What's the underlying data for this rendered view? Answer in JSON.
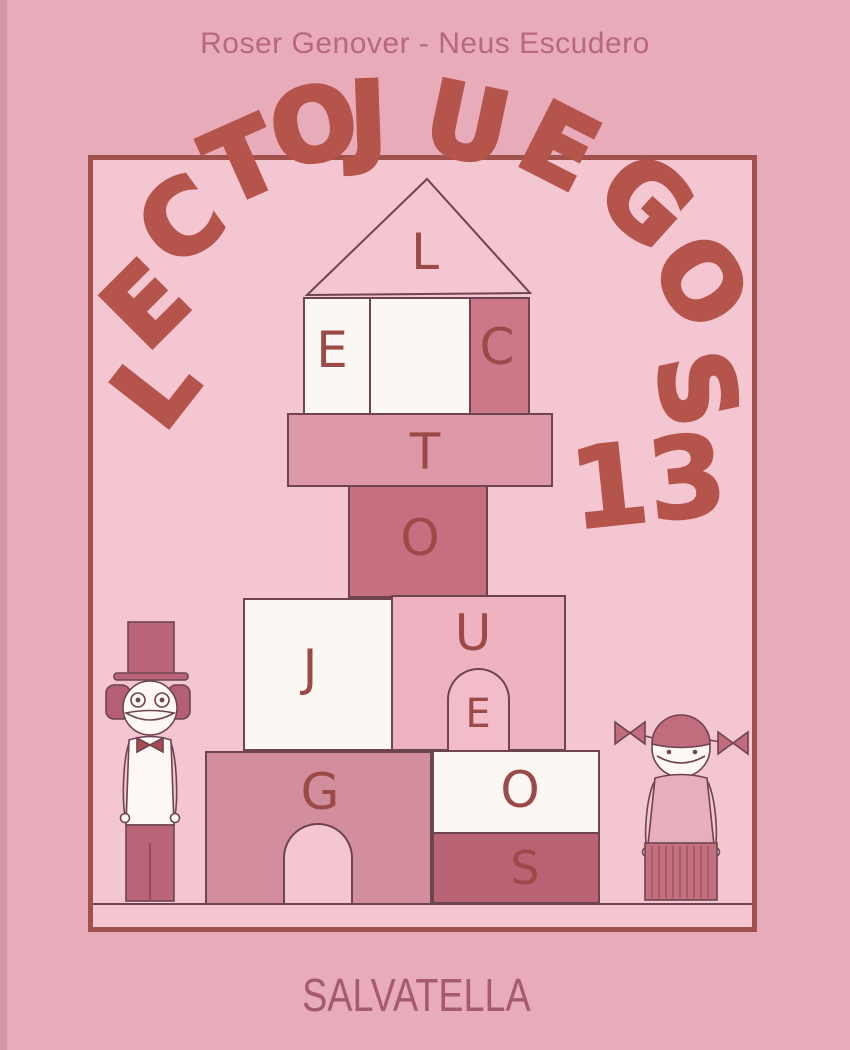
{
  "cover": {
    "author_line": "Roser Genover - Neus Escudero",
    "title": "LECTOJUEGOS",
    "title_letters": [
      "L",
      "E",
      "C",
      "T",
      "O",
      "J",
      "U",
      "E",
      "G",
      "O",
      "S"
    ],
    "volume_number": "13",
    "publisher": "SALVATELLA",
    "block_letters": {
      "roof": "L",
      "wall_left": "E",
      "wall_right": "C",
      "shelf": "T",
      "square": "O",
      "big_left": "J",
      "big_right": "U",
      "door": "E",
      "bottom_left": "G",
      "bottom_right_top": "O",
      "bottom_right_strip": "S"
    },
    "illustration": {
      "left_figure": "boy-with-top-hat-icon",
      "right_figure": "girl-with-pigtails-icon",
      "scene": "toy-block-tower-house"
    },
    "colors": {
      "background_outer": "#e7abba",
      "background_panel": "#f3c6d1",
      "frame_border": "#a0514b",
      "title_red": "#b5544b",
      "block_letter_red": "#9c4a48",
      "author_text": "#b8687c",
      "publisher_text": "#a55b6d",
      "block_dark_pink": "#c66f80",
      "block_medium_pink": "#d28e9c",
      "block_white": "#fbf7f3"
    }
  }
}
